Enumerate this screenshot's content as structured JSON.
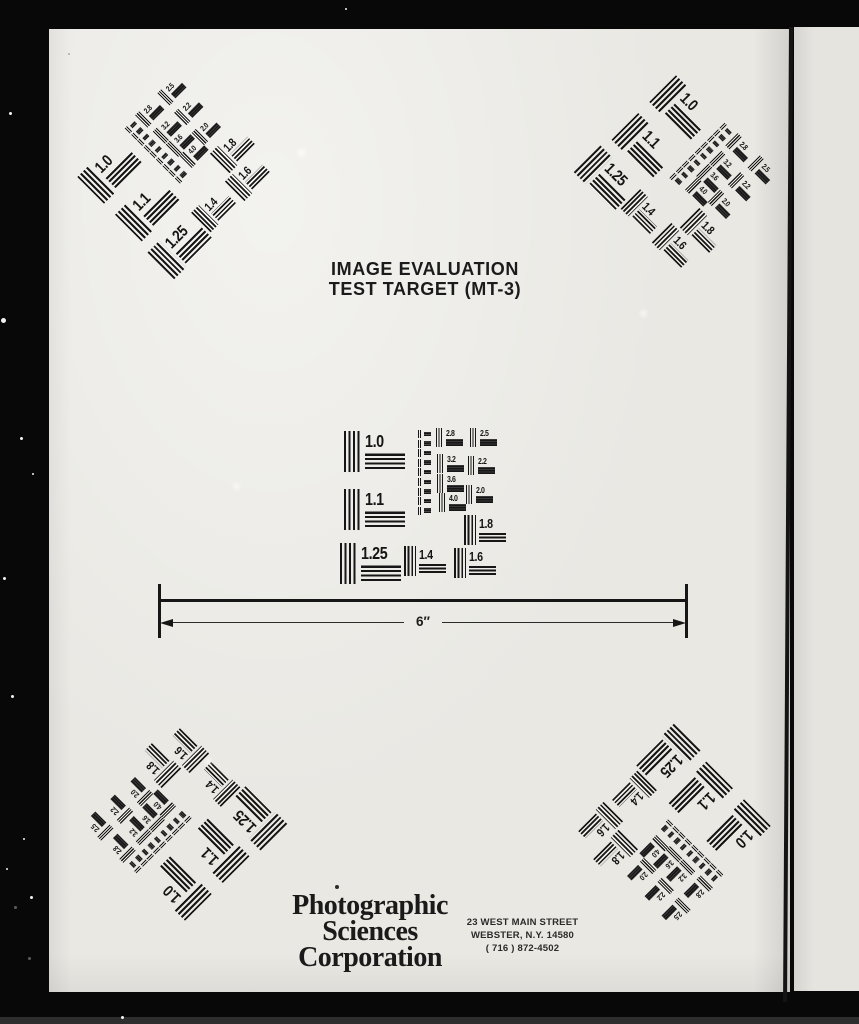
{
  "document": {
    "title_line1": "IMAGE EVALUATION",
    "title_line2": "TEST TARGET (MT-3)",
    "measurement_label": "6″",
    "logo_lines": [
      "Photographic",
      "Sciences",
      "Corporation"
    ],
    "address_lines": [
      "23 WEST MAIN STREET",
      "WEBSTER, N.Y. 14580",
      "( 716 ) 872-4502"
    ]
  },
  "cluster": {
    "patterns": [
      {
        "label": "1.0",
        "size": "big"
      },
      {
        "label": "1.1",
        "size": "big"
      },
      {
        "label": "1.25",
        "size": "big"
      },
      {
        "label": "1.4",
        "size": "medium"
      },
      {
        "label": "1.6",
        "size": "medium"
      },
      {
        "label": "1.8",
        "size": "medium"
      },
      {
        "label": "2.0",
        "size": "small"
      },
      {
        "label": "2.2",
        "size": "small"
      },
      {
        "label": "2.5",
        "size": "small"
      },
      {
        "label": "2.8",
        "size": "small"
      },
      {
        "label": "3.2",
        "size": "small"
      },
      {
        "label": "3.6",
        "size": "small"
      },
      {
        "label": "4.0",
        "size": "small"
      }
    ],
    "micro_stack_count": 9
  },
  "colors": {
    "paper": "#e9e8e3",
    "ink": "#161616",
    "background": "#080808",
    "adjacent_page": "#e5e4df",
    "bottom_strip": "#2e2e2e"
  }
}
